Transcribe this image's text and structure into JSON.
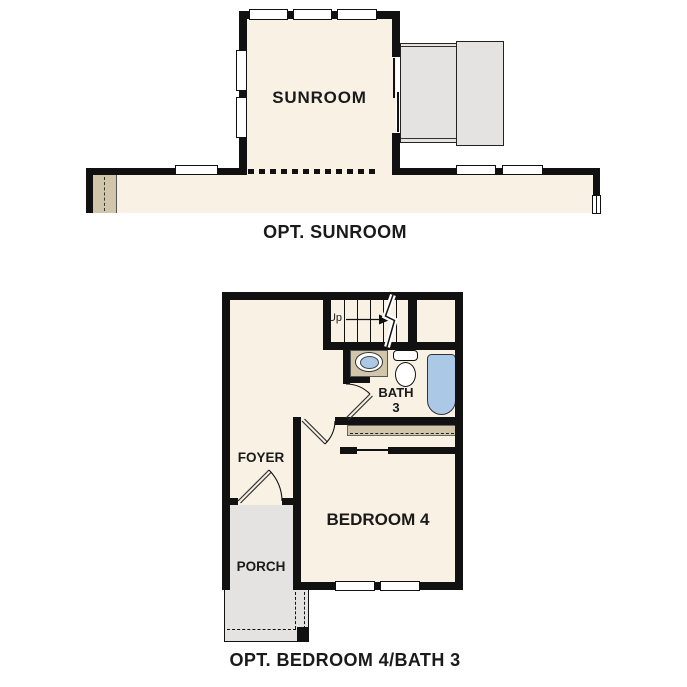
{
  "plans": {
    "sunroom": {
      "caption": "OPT. SUNROOM",
      "room_label": "SUNROOM"
    },
    "bedroom4": {
      "caption": "OPT. BEDROOM 4/BATH 3",
      "labels": {
        "bedroom": "BEDROOM 4",
        "bath_line1": "BATH",
        "bath_line2": "3",
        "foyer": "FOYER",
        "porch": "PORCH",
        "stairs_up": "Up"
      }
    }
  },
  "colors": {
    "background": "#ffffff",
    "floor": "#f8f1e4",
    "wall": "#111111",
    "counter_tan": "#d1c5aa",
    "porch_gray": "#e4e3e1",
    "fixture_blue": "#abc9e6",
    "text": "#1a1a1a"
  }
}
